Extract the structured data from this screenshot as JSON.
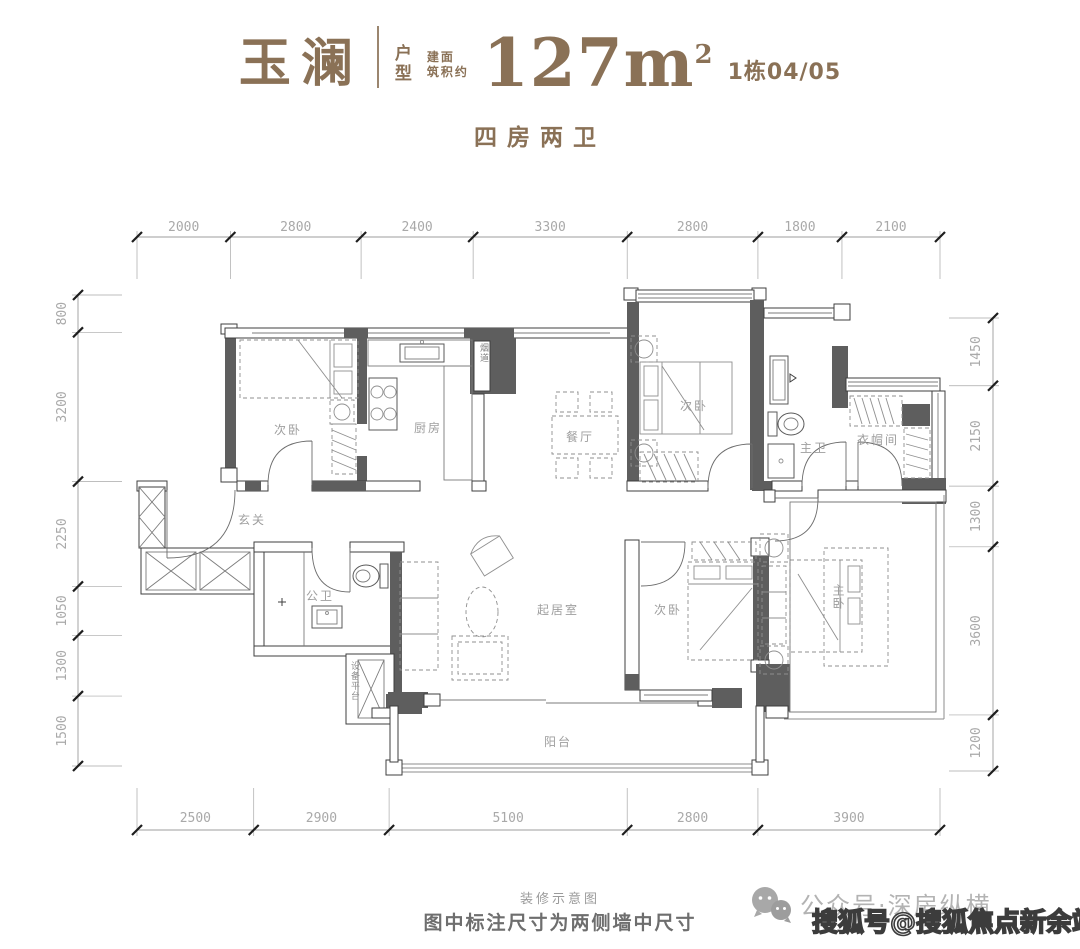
{
  "header": {
    "project_name": "玉澜",
    "type_label_line1": "户",
    "type_label_line2": "型",
    "area_prefix_line1": "建面",
    "area_prefix_line2": "筑积约",
    "area_value": "127m",
    "area_exponent": "2",
    "building_unit": "1栋04/05",
    "subtitle": "四房两卫",
    "accent_color": "#8a7156"
  },
  "dimensions": {
    "top": [
      "2000",
      "2800",
      "2400",
      "3300",
      "2800",
      "1800",
      "2100"
    ],
    "bottom": [
      "2500",
      "2900",
      "5100",
      "2800",
      "3900"
    ],
    "left": [
      "800",
      "3200",
      "2250",
      "1050",
      "1300",
      "1500"
    ],
    "right": [
      "1450",
      "2150",
      "1300",
      "3600",
      "1200"
    ]
  },
  "rooms": {
    "bedroom_top_left": "次卧",
    "kitchen": "厨房",
    "dining": "餐厅",
    "bedroom_top_right": "次卧",
    "master_bath": "主卫",
    "cloakroom": "衣帽间",
    "entry": "玄关",
    "guest_bath": "公卫",
    "living_room": "起居室",
    "bedroom_bottom": "次卧",
    "master_bedroom": "主卧",
    "balcony": "阳台",
    "flue": "烟道",
    "equipment_platform": "设备平台"
  },
  "footer": {
    "note_line1": "装修示意图",
    "note_line2": "图中标注尺寸为两侧墙中尺寸",
    "wechat_account": "公众号·深房纵横",
    "sohu_watermark": "搜狐号@搜狐焦点新余站"
  }
}
